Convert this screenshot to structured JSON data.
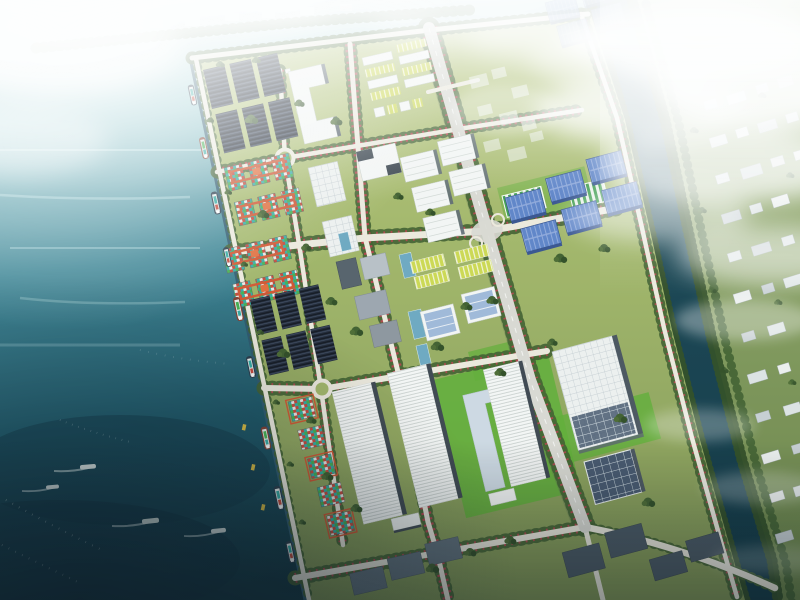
{
  "scene": {
    "type": "aerial-architectural-rendering",
    "subject": "Coastal industrial port and logistics park master plan",
    "description": "Bird's-eye architectural rendering of a waterfront industrial park built on reclaimed land beside a teal sea. Container ships are docked along a diagonal quay. The park holds rooftop-solar arrays, orange gantry cranes over colorful container yards, rows of blue-, white- and lime-roofed warehouses and workshops, bright lawns and boulevards lined with red-flowering trees. An elevated expressway and a dark tree-banked river separate the park from a hazy low-rise town to the east, under bright white clouds.",
    "time_of_day": "hazy daylight",
    "counts": {
      "docked_ships": 9,
      "small_boats": 4,
      "gantry_cranes": 4,
      "rooftop_solar_fields": 2,
      "blue_roof_warehouses": 6,
      "long_ribbed_warehouses": 3,
      "container_yards": 3,
      "roundabouts": 2,
      "river_bridges": 1
    }
  },
  "palette": {
    "sea_top": "#dff0f1",
    "sea_mid": "#3b8494",
    "sea_deep": "#0a2f3c",
    "park_green": "#a0b566",
    "park_dark": "#81994e",
    "lawn": "#5cad33",
    "road": "#ece9dd",
    "highway": "#d9d9d2",
    "road_red": "#c13b4c",
    "tree": "#3c5c2b",
    "tree_dark": "#2c4a21",
    "solar": "#1b2433",
    "crane": "#d0522c",
    "cont_teal": "#2fa9a2",
    "cont_red": "#c54436",
    "cont_green": "#3fae4c",
    "blue_roof": "#5b82c8",
    "blue_roof_light": "#8fa9dc",
    "blue_roof_dark": "#33518e",
    "white_bldg": "#f4f6f5",
    "gray_side": "#4c5862",
    "yellow": "#ccd84e",
    "green_roof": "#3f9e4f",
    "glass": "#6aa7c0",
    "river": "#12404d",
    "town_green": "#7d9955",
    "haze": "#ffffff"
  }
}
